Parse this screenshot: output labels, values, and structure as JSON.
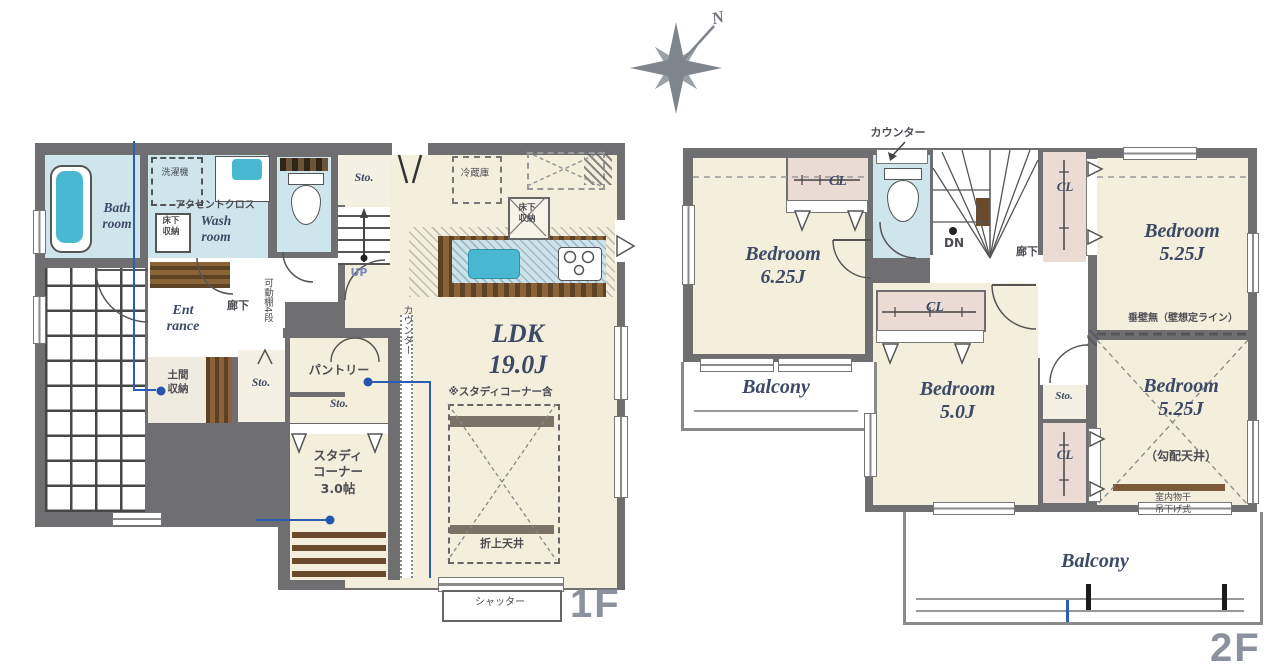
{
  "compass": {
    "north": "N"
  },
  "palette": {
    "wall": "#6f6f72",
    "room_cream": "#f4eedd",
    "water_blue": "#cfe5ec",
    "closet_pink": "#eadcd5",
    "wood_brown": "#7a5a38",
    "tub_teal": "#49b9d2",
    "annotation_blue": "#2b5cb8",
    "floor_label_gray": "#8c929d",
    "label_navy": "#3d4a66"
  },
  "f1": {
    "floor_label": "1F",
    "bath": "Bath\nroom",
    "wash": "Wash\nroom",
    "laundry": "洗濯機",
    "accent_cloth": "アクセントクロス",
    "underfloor_wash": "床下\n収納",
    "sto_hall": "Sto.",
    "up": "UP",
    "corridor": "廊下",
    "shelf": "可動棚4段",
    "entrance": "Ent\nrance",
    "doma": "土間\n収納",
    "sto_entrance": "Sto.",
    "pantry": "パントリー",
    "sto_study": "Sto.",
    "study": "スタディ\nコーナー\n3.0帖",
    "fridge": "冷蔵庫",
    "underfloor_kitchen": "床下\n収納",
    "counter": "カウンター",
    "ldk": "LDK\n19.0J",
    "ldk_note": "※スタディコーナー含",
    "ceiling": "折上天井",
    "shutter": "シャッター"
  },
  "f2": {
    "floor_label": "2F",
    "counter": "カウンター",
    "cl": "CL",
    "bedroom1": "Bedroom\n6.25J",
    "dn": "DN",
    "corridor": "廊下",
    "bedroom2": "Bedroom\n5.25J",
    "no_wall_note": "垂壁無（壁想定ライン）",
    "bedroom3": "Bedroom\n5.25J",
    "sloped_ceiling": "（勾配天井）",
    "drying": "室内物干\n吊下げ式",
    "sto": "Sto.",
    "bedroom4": "Bedroom\n5.0J",
    "balcony_left": "Balcony",
    "balcony_bottom": "Balcony"
  }
}
